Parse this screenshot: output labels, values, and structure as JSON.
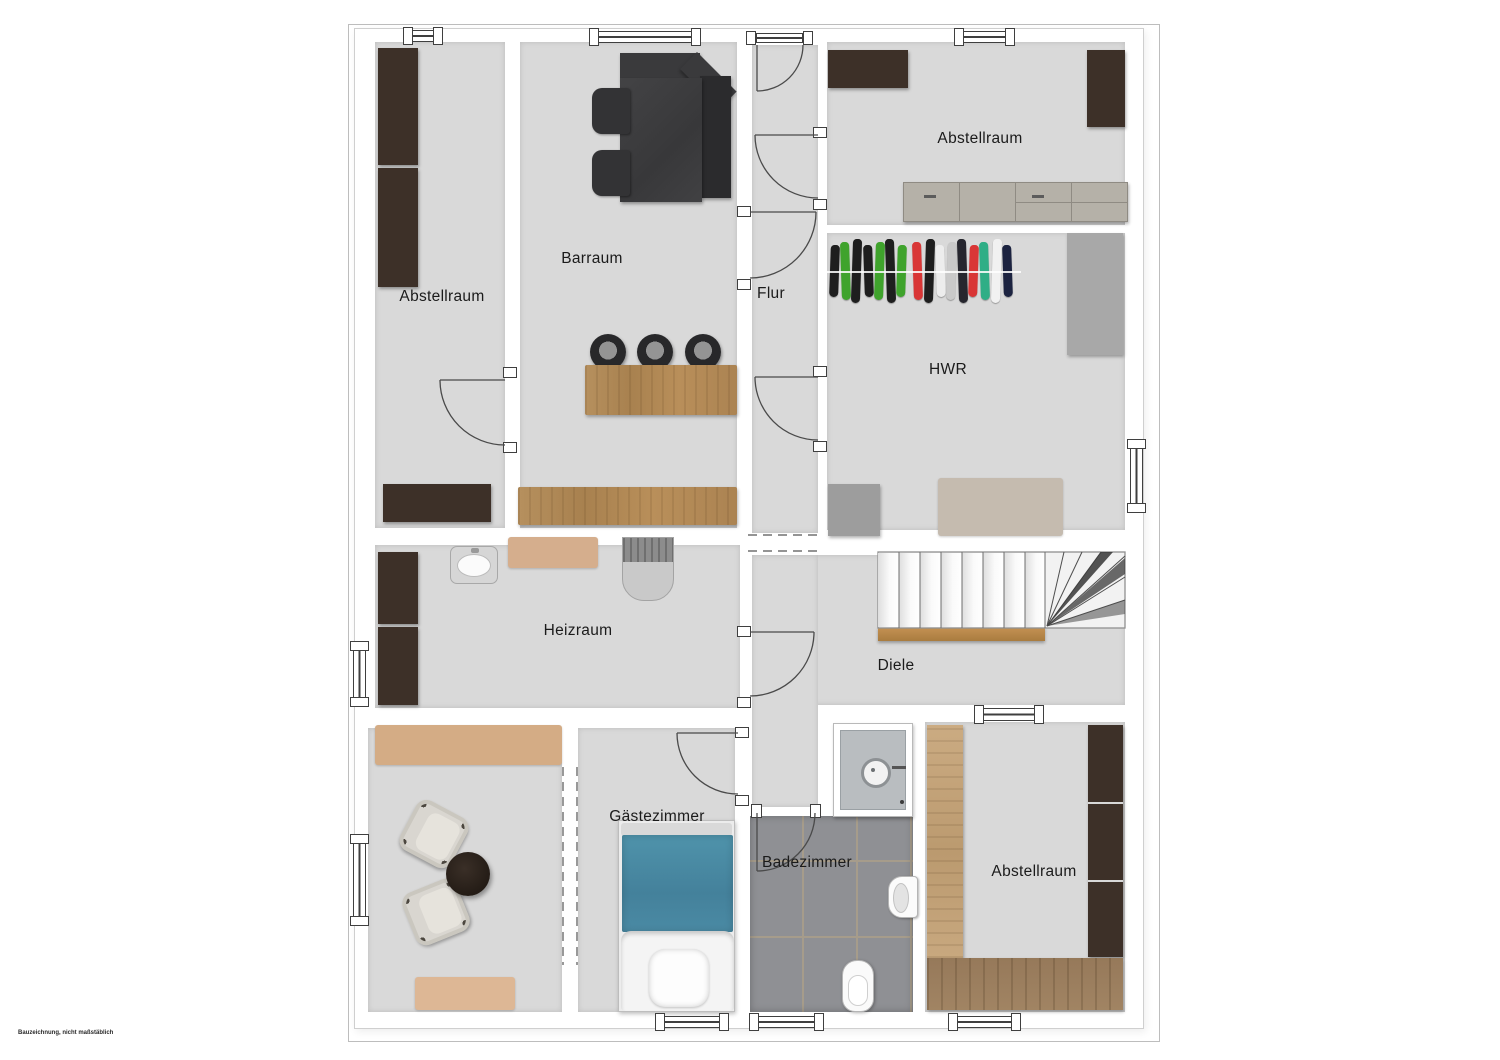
{
  "plan": {
    "rooms": [
      {
        "id": "abstellraum-tl",
        "label": "Abstellraum"
      },
      {
        "id": "barraum",
        "label": "Barraum"
      },
      {
        "id": "flur",
        "label": "Flur"
      },
      {
        "id": "abstellraum-tr",
        "label": "Abstellraum"
      },
      {
        "id": "hwr",
        "label": "HWR"
      },
      {
        "id": "heizraum",
        "label": "Heizraum"
      },
      {
        "id": "diele",
        "label": "Diele"
      },
      {
        "id": "gaestezimmer",
        "label": "Gästezimmer"
      },
      {
        "id": "badezimmer",
        "label": "Badezimmer"
      },
      {
        "id": "abstellraum-br",
        "label": "Abstellraum"
      }
    ],
    "disclaimer": "Bauzeichnung, nicht maßstäblich"
  },
  "palette": {
    "wall": "#ffffff",
    "room_fill": "#d9d9d9",
    "outline": "#444444",
    "dark_brown": "#3d3028",
    "charcoal": "#3a3a3c",
    "wood_counter": "#b08d5f",
    "wood_floor": "#a18463",
    "rug": "#d4ac85",
    "gray_cabinet": "#b5b1a8",
    "bed_teal": "#4a8aa4",
    "tile_gray": "#8f9094",
    "tile_grout": "#a69c8b",
    "stair_wood": "#bf8e4e"
  },
  "hwr_clothes": [
    "#1e1e1e",
    "#3fa32c",
    "#1e1e1e",
    "#1e1e1e",
    "#3fa32c",
    "#1e1e1e",
    "#3fa32c",
    "#d93636",
    "#1e1e1e",
    "#ededed",
    "#c9c9c9",
    "#26262e",
    "#d93636",
    "#2fae86",
    "#f1f1f1",
    "#1c2340"
  ]
}
